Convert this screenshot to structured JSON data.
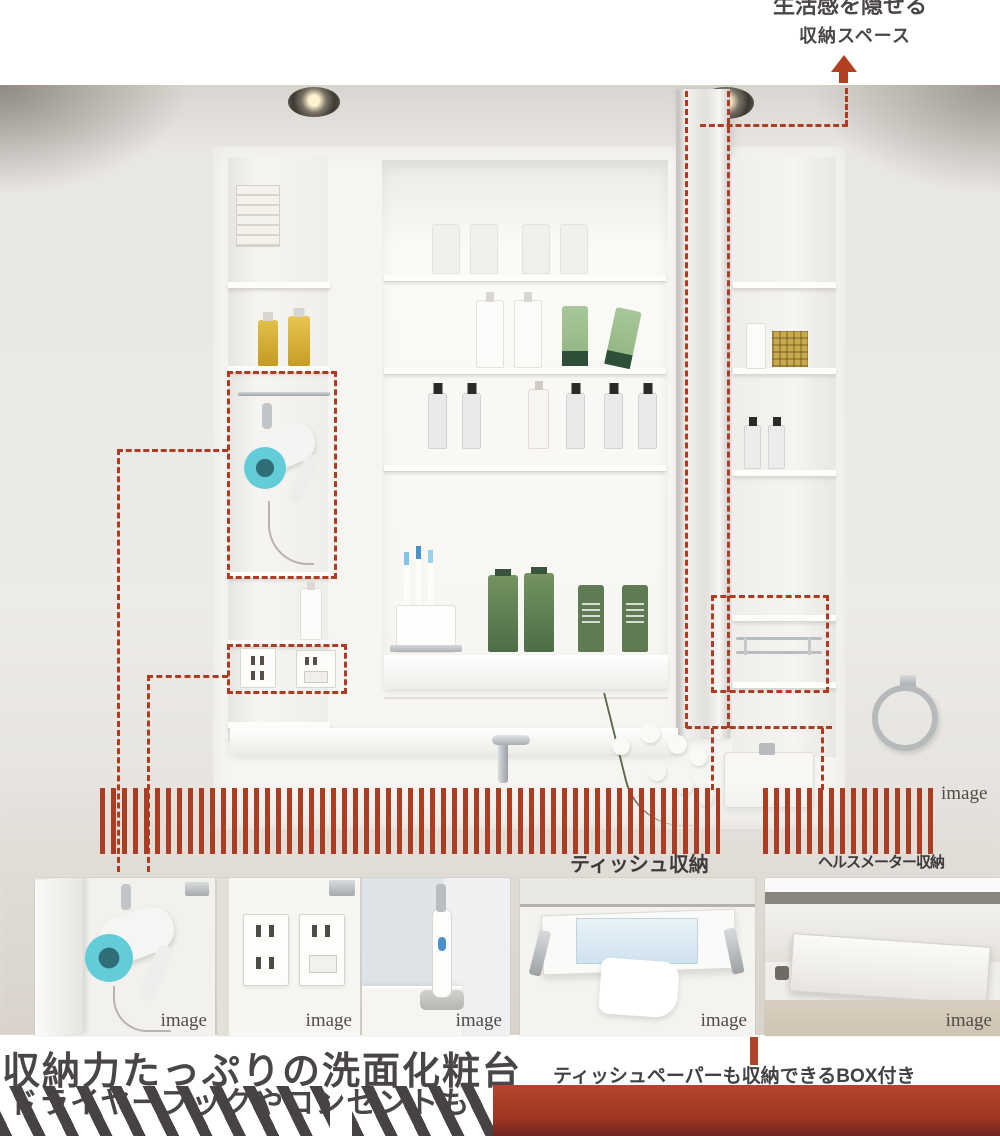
{
  "headline": {
    "line1": "生活感を隠せる",
    "line2": "収納スペース"
  },
  "labels": {
    "tissue": "ティッシュ収納",
    "scale": "ヘルスメーター収納"
  },
  "note": {
    "text": "ティッシュペーパーも収納できるBOX付き"
  },
  "bottom_heading": {
    "line1": "収納力たっぷりの洗面化粧台",
    "line2": "ドライヤーフックやコンセントも"
  },
  "captions": {
    "image": "image"
  },
  "colors": {
    "accent_red": "#ad3d22",
    "band_red": "#a83a25",
    "text_dark": "#474245"
  }
}
